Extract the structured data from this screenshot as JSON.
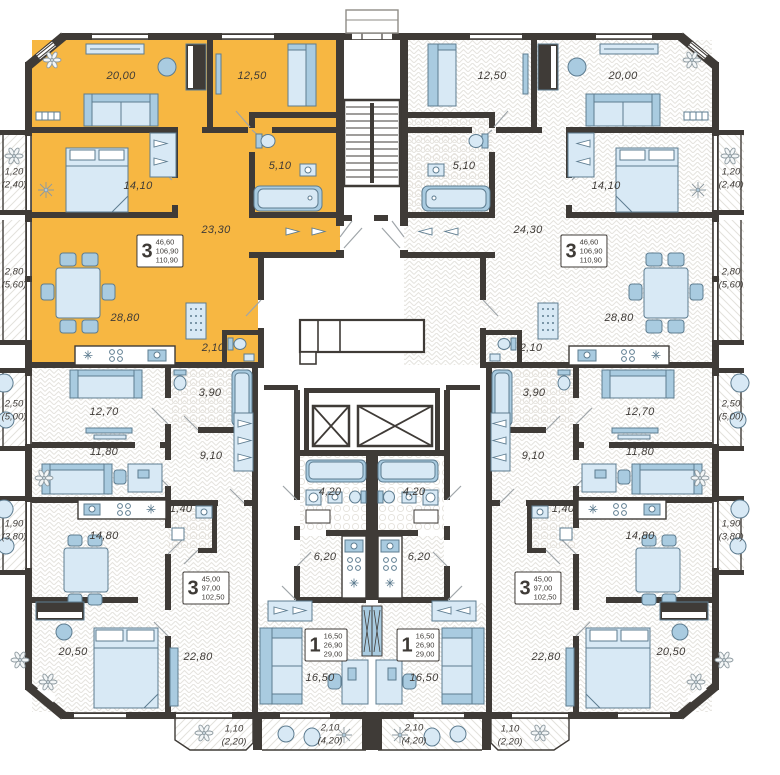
{
  "title": "residential-floor-plan",
  "colors": {
    "highlight": "#F7B742",
    "wall": "#3F3B37",
    "furniture_light": "#D8E9F5",
    "furniture_mid": "#A9CBE0",
    "text": "#3F3B37"
  },
  "apartments": {
    "top_left": {
      "type": "3-room",
      "highlighted": true,
      "info": {
        "count": "3",
        "living_area": "46,60",
        "area": "106,90",
        "total_area": "110,90"
      },
      "rooms": {
        "living": "20,00",
        "bedroom_small": "12,50",
        "bathroom": "5,10",
        "bedroom": "14,10",
        "hall": "23,30",
        "kitchen_living": "28,80",
        "wc": "2,10"
      },
      "balconies": {
        "b1": {
          "area": "1,20",
          "total": "(2,40)"
        },
        "b2": {
          "area": "2,80",
          "total": "(5,60)"
        }
      }
    },
    "top_right": {
      "type": "3-room",
      "highlighted": false,
      "info": {
        "count": "3",
        "living_area": "46,60",
        "area": "106,90",
        "total_area": "110,90"
      },
      "rooms": {
        "living": "20,00",
        "bedroom_small": "12,50",
        "bathroom": "5,10",
        "bedroom": "14,10",
        "hall": "24,30",
        "kitchen_living": "28,80",
        "wc": "2,10"
      },
      "balconies": {
        "b1": {
          "area": "1,20",
          "total": "(2,40)"
        },
        "b2": {
          "area": "2,80",
          "total": "(5,60)"
        }
      }
    },
    "mid_left": {
      "type": "3-room",
      "highlighted": false,
      "info": {
        "count": "3",
        "living_area": "45,00",
        "area": "97,00",
        "total_area": "102,50"
      },
      "rooms": {
        "bedroom1": "12,70",
        "bathroom": "3,90",
        "hall": "9,10",
        "bedroom2": "11,80",
        "kitchen": "14,80",
        "wc": "1,40",
        "bedroom3": "20,50",
        "living": "22,80"
      },
      "balconies": {
        "b1": {
          "area": "2,50",
          "total": "(5,00)"
        },
        "b2": {
          "area": "1,90",
          "total": "(3,80)"
        },
        "b3": {
          "area": "1,10",
          "total": "(2,20)"
        }
      }
    },
    "mid_right": {
      "type": "3-room",
      "highlighted": false,
      "info": {
        "count": "3",
        "living_area": "45,00",
        "area": "97,00",
        "total_area": "102,50"
      },
      "rooms": {
        "bedroom1": "12,70",
        "bathroom": "3,90",
        "hall": "9,10",
        "bedroom2": "11,80",
        "kitchen": "14,80",
        "wc": "1,40",
        "bedroom3": "20,50",
        "living": "22,80"
      },
      "balconies": {
        "b1": {
          "area": "2,50",
          "total": "(5,00)"
        },
        "b2": {
          "area": "1,90",
          "total": "(3,80)"
        },
        "b3": {
          "area": "1,10",
          "total": "(2,20)"
        }
      }
    },
    "studio_left": {
      "type": "1-room",
      "highlighted": false,
      "info": {
        "count": "1",
        "living_area": "16,50",
        "area": "26,90",
        "total_area": "29,00"
      },
      "rooms": {
        "bathroom": "4,20",
        "kitchen": "6,20",
        "living": "16,50"
      },
      "balconies": {
        "b1": {
          "area": "2,10",
          "total": "(4,20)"
        }
      }
    },
    "studio_right": {
      "type": "1-room",
      "highlighted": false,
      "info": {
        "count": "1",
        "living_area": "16,50",
        "area": "26,90",
        "total_area": "29,00"
      },
      "rooms": {
        "bathroom": "4,20",
        "kitchen": "6,20",
        "living": "16,50"
      },
      "balconies": {
        "b1": {
          "area": "2,10",
          "total": "(4,20)"
        }
      }
    }
  }
}
